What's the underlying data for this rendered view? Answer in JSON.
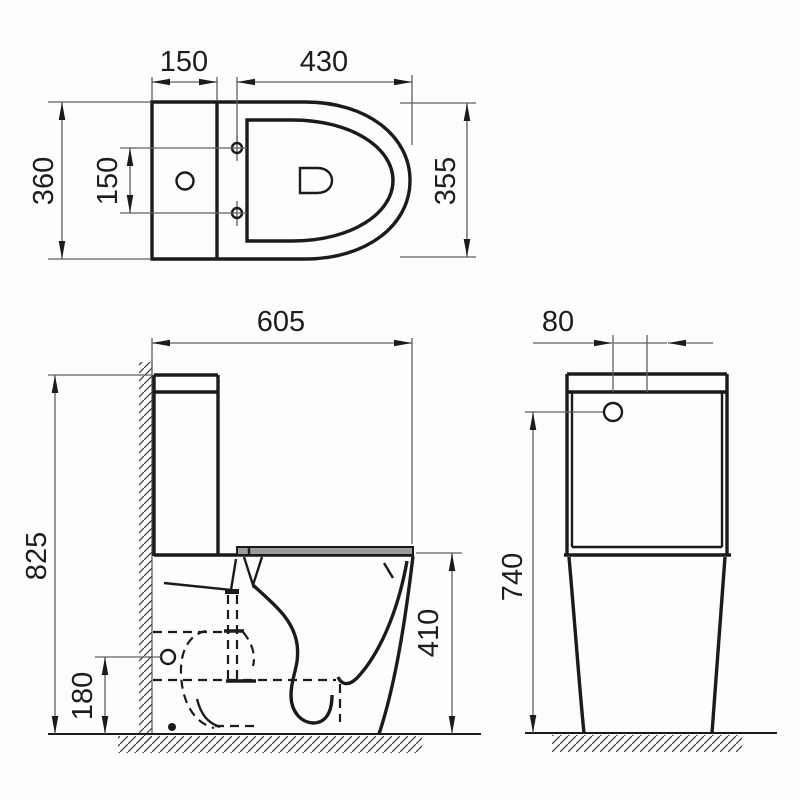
{
  "drawing": {
    "colors": {
      "line": "#1b1b1b",
      "thin_line": "#5f5f5f",
      "seat_fill": "#9c9c9c",
      "background": "#ffffff"
    },
    "plan_view": {
      "labels": {
        "tank_depth": "150",
        "bowl_depth": "430",
        "overall_width": "360",
        "fixing_hole_spacing": "150",
        "bowl_width": "355"
      }
    },
    "side_view": {
      "labels": {
        "overall_depth": "605",
        "overall_height": "825",
        "outlet_height": "180",
        "bowl_height": "410"
      }
    },
    "front_view": {
      "labels": {
        "button_offset": "80",
        "cistern_height": "740"
      }
    }
  }
}
